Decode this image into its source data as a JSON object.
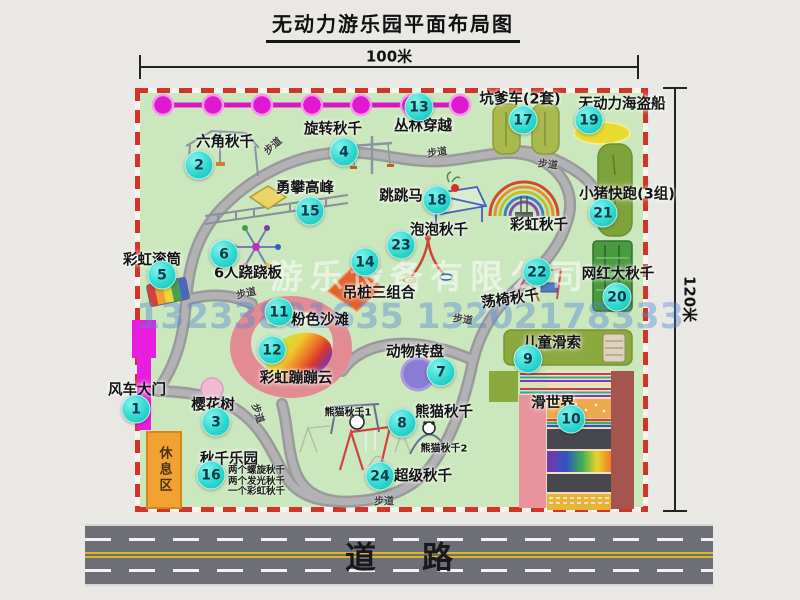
{
  "title": "无动力游乐园平面布局图",
  "dimensions": {
    "width": "100米",
    "height": "120米"
  },
  "road": {
    "label": "道路"
  },
  "watermark": {
    "company": "游乐设备有限公司",
    "phone": "13233801635 13202178333"
  },
  "rest_area": {
    "label": "休息区"
  },
  "walkway_label": "步道",
  "colors": {
    "park_green": "#cbe7bd",
    "border_red": "#d3342a",
    "path_gray": "#a4a4a6",
    "badge_cyan": "#2ed9d0",
    "chain_magenta": "#e01ccb",
    "gate_magenta": "#e81ddd",
    "rest_orange": "#f2a233",
    "road_gray": "#6e6e76"
  },
  "walkways": [
    {
      "x": 272,
      "y": 145,
      "rot": -42
    },
    {
      "x": 437,
      "y": 151,
      "rot": -8
    },
    {
      "x": 548,
      "y": 163,
      "rot": 6
    },
    {
      "x": 246,
      "y": 292,
      "rot": -12
    },
    {
      "x": 463,
      "y": 318,
      "rot": 8
    },
    {
      "x": 259,
      "y": 413,
      "rot": 72
    },
    {
      "x": 384,
      "y": 500,
      "rot": 0
    }
  ],
  "attractions": [
    {
      "num": "1",
      "name": "风车大门",
      "badge": {
        "x": 136,
        "y": 409
      },
      "label": {
        "x": 137,
        "y": 389
      }
    },
    {
      "num": "2",
      "name": "六角秋千",
      "badge": {
        "x": 199,
        "y": 165
      },
      "label": {
        "x": 225,
        "y": 141
      }
    },
    {
      "num": "3",
      "name": "樱花树",
      "badge": {
        "x": 216,
        "y": 422
      },
      "label": {
        "x": 213,
        "y": 404
      }
    },
    {
      "num": "4",
      "name": "旋转秋千",
      "badge": {
        "x": 344,
        "y": 152
      },
      "label": {
        "x": 333,
        "y": 128
      }
    },
    {
      "num": "5",
      "name": "彩虹滚筒",
      "badge": {
        "x": 162,
        "y": 275
      },
      "label": {
        "x": 152,
        "y": 259
      }
    },
    {
      "num": "6",
      "name": "6人跷跷板",
      "badge": {
        "x": 224,
        "y": 254
      },
      "label": {
        "x": 248,
        "y": 272
      }
    },
    {
      "num": "7",
      "name": "动物转盘",
      "badge": {
        "x": 441,
        "y": 372
      },
      "label": {
        "x": 415,
        "y": 351
      }
    },
    {
      "num": "8",
      "name": "熊猫秋千",
      "badge": {
        "x": 402,
        "y": 423
      },
      "label": {
        "x": 444,
        "y": 411
      }
    },
    {
      "num": "9",
      "name": "儿童滑索",
      "badge": {
        "x": 528,
        "y": 359
      },
      "label": {
        "x": 552,
        "y": 342
      }
    },
    {
      "num": "10",
      "name": "滑世界",
      "badge": {
        "x": 571,
        "y": 419
      },
      "label": {
        "x": 553,
        "y": 402
      }
    },
    {
      "num": "11",
      "name": "粉色沙滩",
      "badge": {
        "x": 279,
        "y": 312
      },
      "label": {
        "x": 320,
        "y": 319
      }
    },
    {
      "num": "12",
      "name": "彩虹蹦蹦云",
      "badge": {
        "x": 272,
        "y": 350
      },
      "label": {
        "x": 296,
        "y": 377
      }
    },
    {
      "num": "13",
      "name": "丛林穿越",
      "badge": {
        "x": 419,
        "y": 107
      },
      "label": {
        "x": 423,
        "y": 125
      }
    },
    {
      "num": "14",
      "name": "吊桩三组合",
      "badge": {
        "x": 365,
        "y": 262
      },
      "label": {
        "x": 379,
        "y": 292
      }
    },
    {
      "num": "15",
      "name": "勇攀高峰",
      "badge": {
        "x": 310,
        "y": 211
      },
      "label": {
        "x": 305,
        "y": 187
      }
    },
    {
      "num": "16",
      "name": "秋千乐园",
      "badge": {
        "x": 211,
        "y": 475
      },
      "label": {
        "x": 229,
        "y": 458
      },
      "notes": [
        "两个螺旋秋千",
        "两个发光秋千",
        "一个彩虹秋千"
      ],
      "notes_pos": {
        "x": 228,
        "y": 466
      }
    },
    {
      "num": "17",
      "name": "坑爹车(2套)",
      "badge": {
        "x": 523,
        "y": 120
      },
      "label": {
        "x": 520,
        "y": 98
      }
    },
    {
      "num": "18",
      "name": "跳跳马",
      "badge": {
        "x": 437,
        "y": 200
      },
      "label": {
        "x": 401,
        "y": 195
      }
    },
    {
      "num": "19",
      "name": "无动力海盗船",
      "badge": {
        "x": 589,
        "y": 120
      },
      "label": {
        "x": 622,
        "y": 103
      }
    },
    {
      "num": "20",
      "name": "网红大秋千",
      "badge": {
        "x": 617,
        "y": 297
      },
      "label": {
        "x": 618,
        "y": 273
      }
    },
    {
      "num": "21",
      "name": "小猪快跑(3组)",
      "badge": {
        "x": 603,
        "y": 213
      },
      "label": {
        "x": 627,
        "y": 193
      }
    },
    {
      "num": "22",
      "name": "荡椅秋千",
      "badge": {
        "x": 537,
        "y": 272
      },
      "label": {
        "x": 510,
        "y": 298,
        "rot": -8
      }
    },
    {
      "num": "23",
      "name": "泡泡秋千",
      "badge": {
        "x": 401,
        "y": 245
      },
      "label": {
        "x": 439,
        "y": 229
      }
    },
    {
      "num": "24",
      "name": "超级秋千",
      "badge": {
        "x": 380,
        "y": 476
      },
      "label": {
        "x": 423,
        "y": 475
      }
    }
  ],
  "unnumbered_labels": [
    {
      "name": "彩虹秋千",
      "x": 539,
      "y": 224,
      "size": "normal"
    },
    {
      "name": "熊猫秋千1",
      "x": 348,
      "y": 411,
      "size": "small"
    },
    {
      "name": "熊猫秋千2",
      "x": 444,
      "y": 447,
      "size": "small"
    }
  ]
}
